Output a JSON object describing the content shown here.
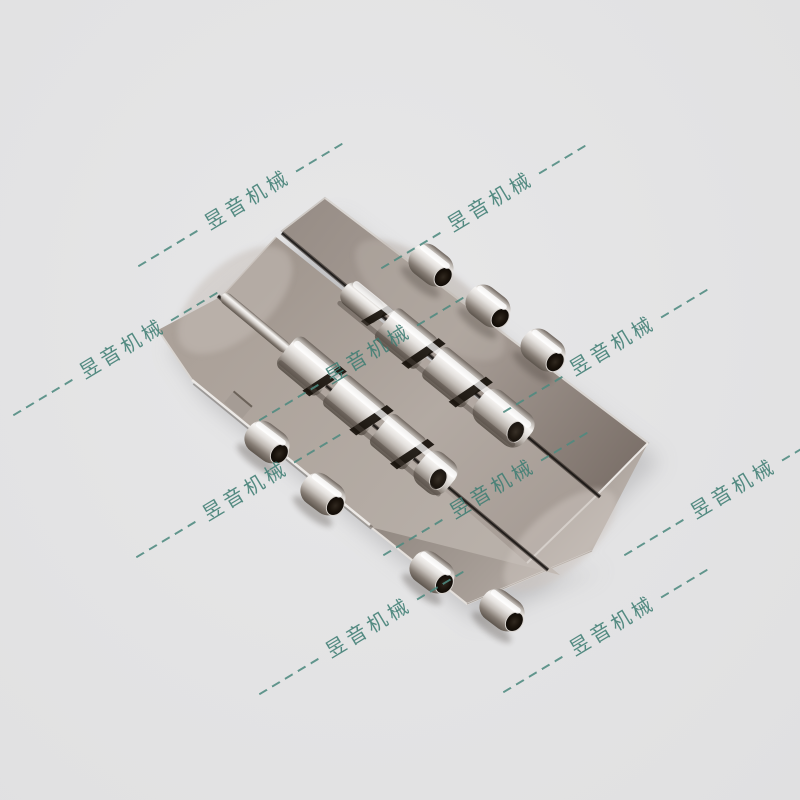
{
  "background": {
    "color": "#e3e3e4"
  },
  "watermark": {
    "text": "昱音机械",
    "color": "#3f7e74",
    "dash_color": "#4e8a80",
    "rotation_deg": -31,
    "stamps": [
      {
        "x": 242,
        "y": 204
      },
      {
        "x": 485,
        "y": 206
      },
      {
        "x": 117,
        "y": 353
      },
      {
        "x": 363,
        "y": 358
      },
      {
        "x": 607,
        "y": 350
      },
      {
        "x": 240,
        "y": 495
      },
      {
        "x": 487,
        "y": 493
      },
      {
        "x": 728,
        "y": 493
      },
      {
        "x": 363,
        "y": 632
      },
      {
        "x": 607,
        "y": 630
      }
    ]
  },
  "product": {
    "alt": "Stainless steel piano hinge plates with barrel knuckles and hinge pins, shown diagonally on a gray background",
    "steel_light": "#f6f4f2",
    "steel_mid": "#aca29b",
    "steel_dark": "#6e655e",
    "gap_black": "#16100a"
  }
}
